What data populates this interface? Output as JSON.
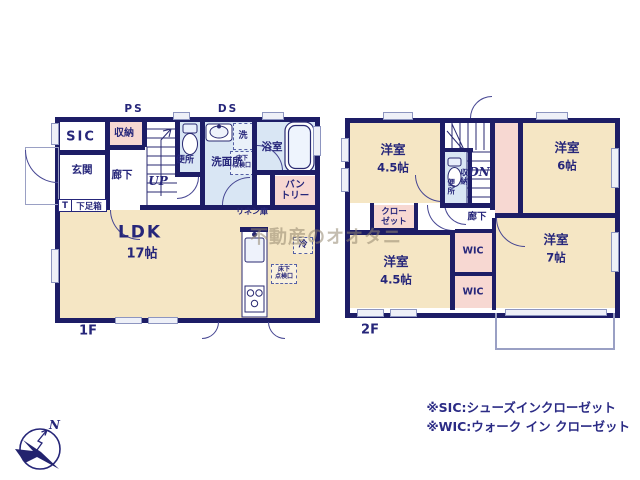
{
  "watermark": "不動産のオオタニ",
  "floor1": {
    "name": "1F",
    "labels": {
      "sic": "SIC",
      "storage": "収納",
      "ps": "PS",
      "ds": "DS",
      "entrance": "玄関",
      "hall": "廊下",
      "up": "UP",
      "toilet": "便所",
      "washroom": "洗面所",
      "bath": "浴室",
      "wash": "洗",
      "underfloor1": "床下",
      "underfloor2": "点検口",
      "pantry1": "バン",
      "pantry2": "トリー",
      "linen": "リネン庫",
      "fridge": "冷",
      "t": "T",
      "shoebox": "下足箱",
      "ldk": "LDK",
      "ldk_size": "17帖"
    }
  },
  "floor2": {
    "name": "2F",
    "labels": {
      "room_nw": "洋室",
      "room_nw_size": "4.5帖",
      "room_ne": "洋室",
      "room_ne_size": "6帖",
      "room_sw": "洋室",
      "room_sw_size": "4.5帖",
      "room_se": "洋室",
      "room_se_size": "7帖",
      "closet1": "クロー",
      "closet2": "ゼット",
      "wic_upper": "WIC",
      "wic_lower": "WIC",
      "toilet": "便所",
      "storage": "収納",
      "hall": "廊下",
      "dn": "DN"
    }
  },
  "notes": {
    "sic": "※SIC:シューズインクローゼット",
    "wic": "※WIC:ウォーク イン クローゼット"
  },
  "compass": {
    "north": "N"
  }
}
